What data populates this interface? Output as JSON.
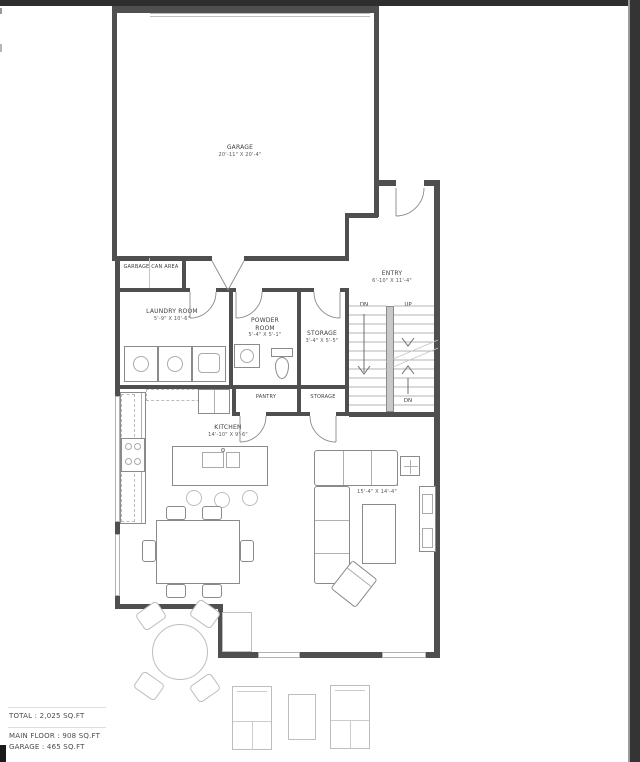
{
  "plan": {
    "rooms": {
      "garage": {
        "name": "GARAGE",
        "dims": "20'-11\" X 20'-4\""
      },
      "garbage": {
        "name": "GARBAGE CAN AREA"
      },
      "laundry": {
        "name": "LAUNDRY ROOM",
        "dims": "5'-9\" X 10'-6\""
      },
      "powder": {
        "name": "POWDER ROOM",
        "dims": "5'-4\" X 5'-1\""
      },
      "storage_upper": {
        "name": "STORAGE",
        "dims": "3'-4\" X 5'-5\""
      },
      "entry": {
        "name": "ENTRY",
        "dims": "6'-10\" X 11'-4\""
      },
      "pantry": {
        "name": "PANTRY"
      },
      "storage_lower": {
        "name": "STORAGE"
      },
      "kitchen": {
        "name": "KITCHEN",
        "dims": "14'-10\" X 9'-6\""
      },
      "living": {
        "name": "LIVING ROOM",
        "dims": "15'-4\" X 14'-4\""
      },
      "dining": {
        "name": "DINING ROOM",
        "dims": "9'-6\" X 10'-3\""
      }
    },
    "stairs": {
      "down_left": "DN",
      "up": "UP",
      "down_right": "DN"
    },
    "summary": {
      "total": "TOTAL : 2,025 SQ.FT",
      "main_floor": "MAIN FLOOR : 908 SQ.FT",
      "garage": "GARAGE : 465 SQ.FT"
    },
    "colors": {
      "wall": "#4f4f4f",
      "window": "#b2b2b2",
      "furniture_outline": "#8a8a8a",
      "light_outline": "#bdbdbd",
      "label_text": "#3c3c3c",
      "scan_artifact": "#2e2e2e"
    }
  }
}
